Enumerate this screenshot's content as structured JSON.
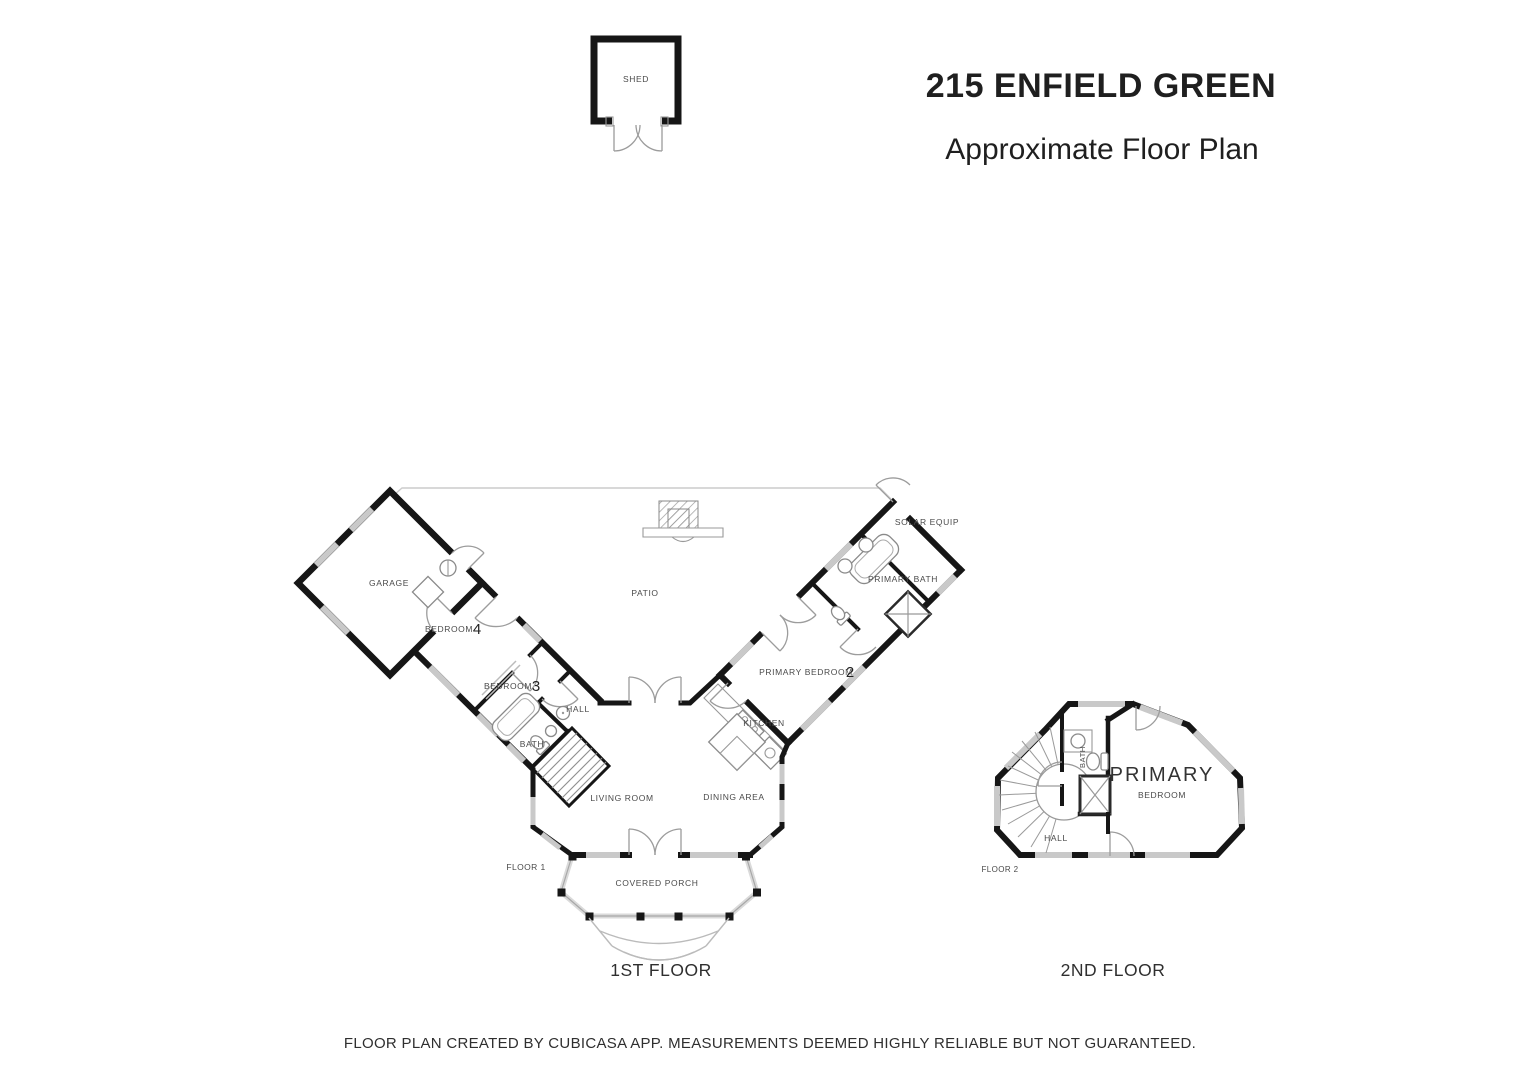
{
  "header": {
    "title": "215 ENFIELD GREEN",
    "subtitle": "Approximate Floor Plan"
  },
  "shed": {
    "label": "SHED"
  },
  "floor1": {
    "caption": "1ST FLOOR",
    "tag": "FLOOR 1",
    "garage": "GARAGE",
    "bedroom4_name": "BEDROOM",
    "bedroom4_num": "4",
    "bedroom3_name": "BEDROOM",
    "bedroom3_num": "3",
    "hall": "HALL",
    "bath": "BATH",
    "patio": "PATIO",
    "living_room": "LIVING ROOM",
    "dining_area": "DINING AREA",
    "kitchen": "KITCHEN",
    "primary_bedroom_name": "PRIMARY BEDROOM",
    "primary_bedroom_num": "2",
    "primary_bath": "PRIMARY BATH",
    "solar_equip": "SOLAR EQUIP",
    "covered_porch": "COVERED PORCH"
  },
  "floor2": {
    "caption": "2ND FLOOR",
    "tag": "FLOOR 2",
    "primary": "PRIMARY",
    "primary_sub": "BEDROOM",
    "bath": "BATH",
    "hall": "HALL"
  },
  "footer": {
    "disclaimer": "FLOOR PLAN CREATED BY CUBICASA APP. MEASUREMENTS DEEMED HIGHLY RELIABLE BUT NOT GUARANTEED."
  },
  "colors": {
    "wall": "#161616",
    "window": "#c9c9c9",
    "door_arc": "#9c9c9c",
    "fixture": "#8a8a8a",
    "label": "#4a4a4a"
  }
}
